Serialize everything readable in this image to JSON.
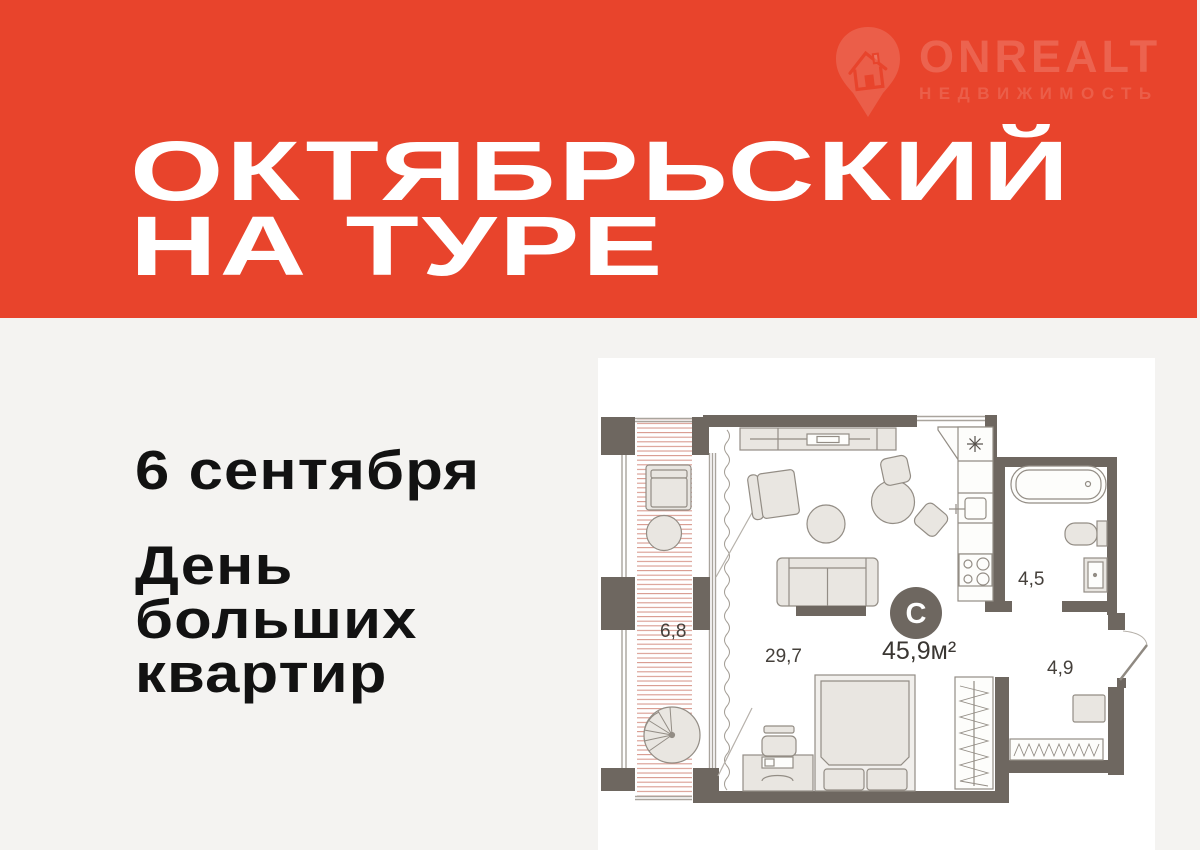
{
  "meta": {
    "width": 1200,
    "height": 850
  },
  "brand": {
    "name": "ONREALT",
    "tagline": "НЕДВИЖИМОСТЬ",
    "icon": "house-pin-icon"
  },
  "header": {
    "title_line1": "ОКТЯБРЬСКИЙ",
    "title_line2": "НА ТУРЕ",
    "background_color": "#e8442c",
    "text_color": "#ffffff"
  },
  "promo": {
    "date": "6 сентября",
    "slogan_lines": [
      "День",
      "больших",
      "квартир"
    ],
    "text_color": "#121212",
    "background_color": "#f4f3f1"
  },
  "floorplan": {
    "badge": "С",
    "total_area": "45,9м²",
    "room_areas": {
      "balcony": "6,8",
      "living": "29,7",
      "bathroom": "4,5",
      "hallway": "4,9"
    },
    "colors": {
      "wall": "#6e6760",
      "furniture_fill": "#e9e6e1",
      "furniture_stroke": "#938d85",
      "balcony_hatch": "#d89a8e",
      "label": "#45403b",
      "badge": "#6e6760"
    }
  }
}
